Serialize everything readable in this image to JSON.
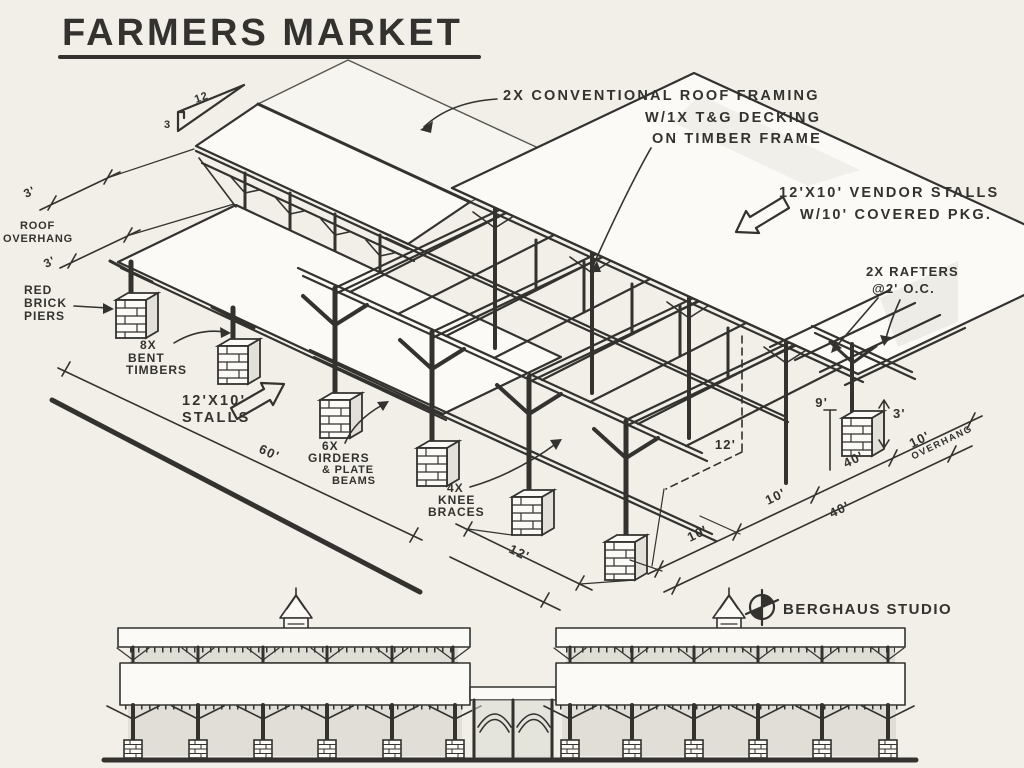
{
  "title": "FARMERS MARKET",
  "pitch": {
    "run": "12",
    "rise": "3"
  },
  "callouts": {
    "roof_framing": [
      "2X CONVENTIONAL ROOF FRAMING",
      "W/1X T&G DECKING",
      "ON TIMBER FRAME"
    ],
    "vendor_stalls": [
      "12'X10' VENDOR STALLS",
      "W/10' COVERED PKG."
    ],
    "rafters": [
      "2X RAFTERS",
      "@2' O.C."
    ],
    "roof_overhang": [
      "ROOF",
      "OVERHANG"
    ],
    "red_brick_piers": [
      "RED",
      "BRICK",
      "PIERS"
    ],
    "bent_timbers": [
      "8X",
      "BENT",
      "TIMBERS"
    ],
    "stalls": [
      "12'X10'",
      "STALLS"
    ],
    "girders": [
      "6X",
      "GIRDERS",
      "& PLATE",
      "BEAMS"
    ],
    "knee_braces": [
      "4X",
      "KNEE",
      "BRACES"
    ]
  },
  "dimensions": {
    "length_total": "60'",
    "stall_bay": "12'",
    "post_height": "12'",
    "eave_height": "9'",
    "pier_height": "3'",
    "roof_overhang_upper": "3'",
    "roof_overhang_lower": "3'",
    "depth_bays": [
      "10'",
      "10'",
      "10'"
    ],
    "depth_total": "40'",
    "parking_overhang": [
      "10'",
      "OVERHANG"
    ]
  },
  "studio": "BERGHAUS STUDIO",
  "colors": {
    "paper": "#f1efe8",
    "ink": "#33322e",
    "roof_white": "#fbfaf7",
    "shadow_wash": "#d9d8d1"
  }
}
